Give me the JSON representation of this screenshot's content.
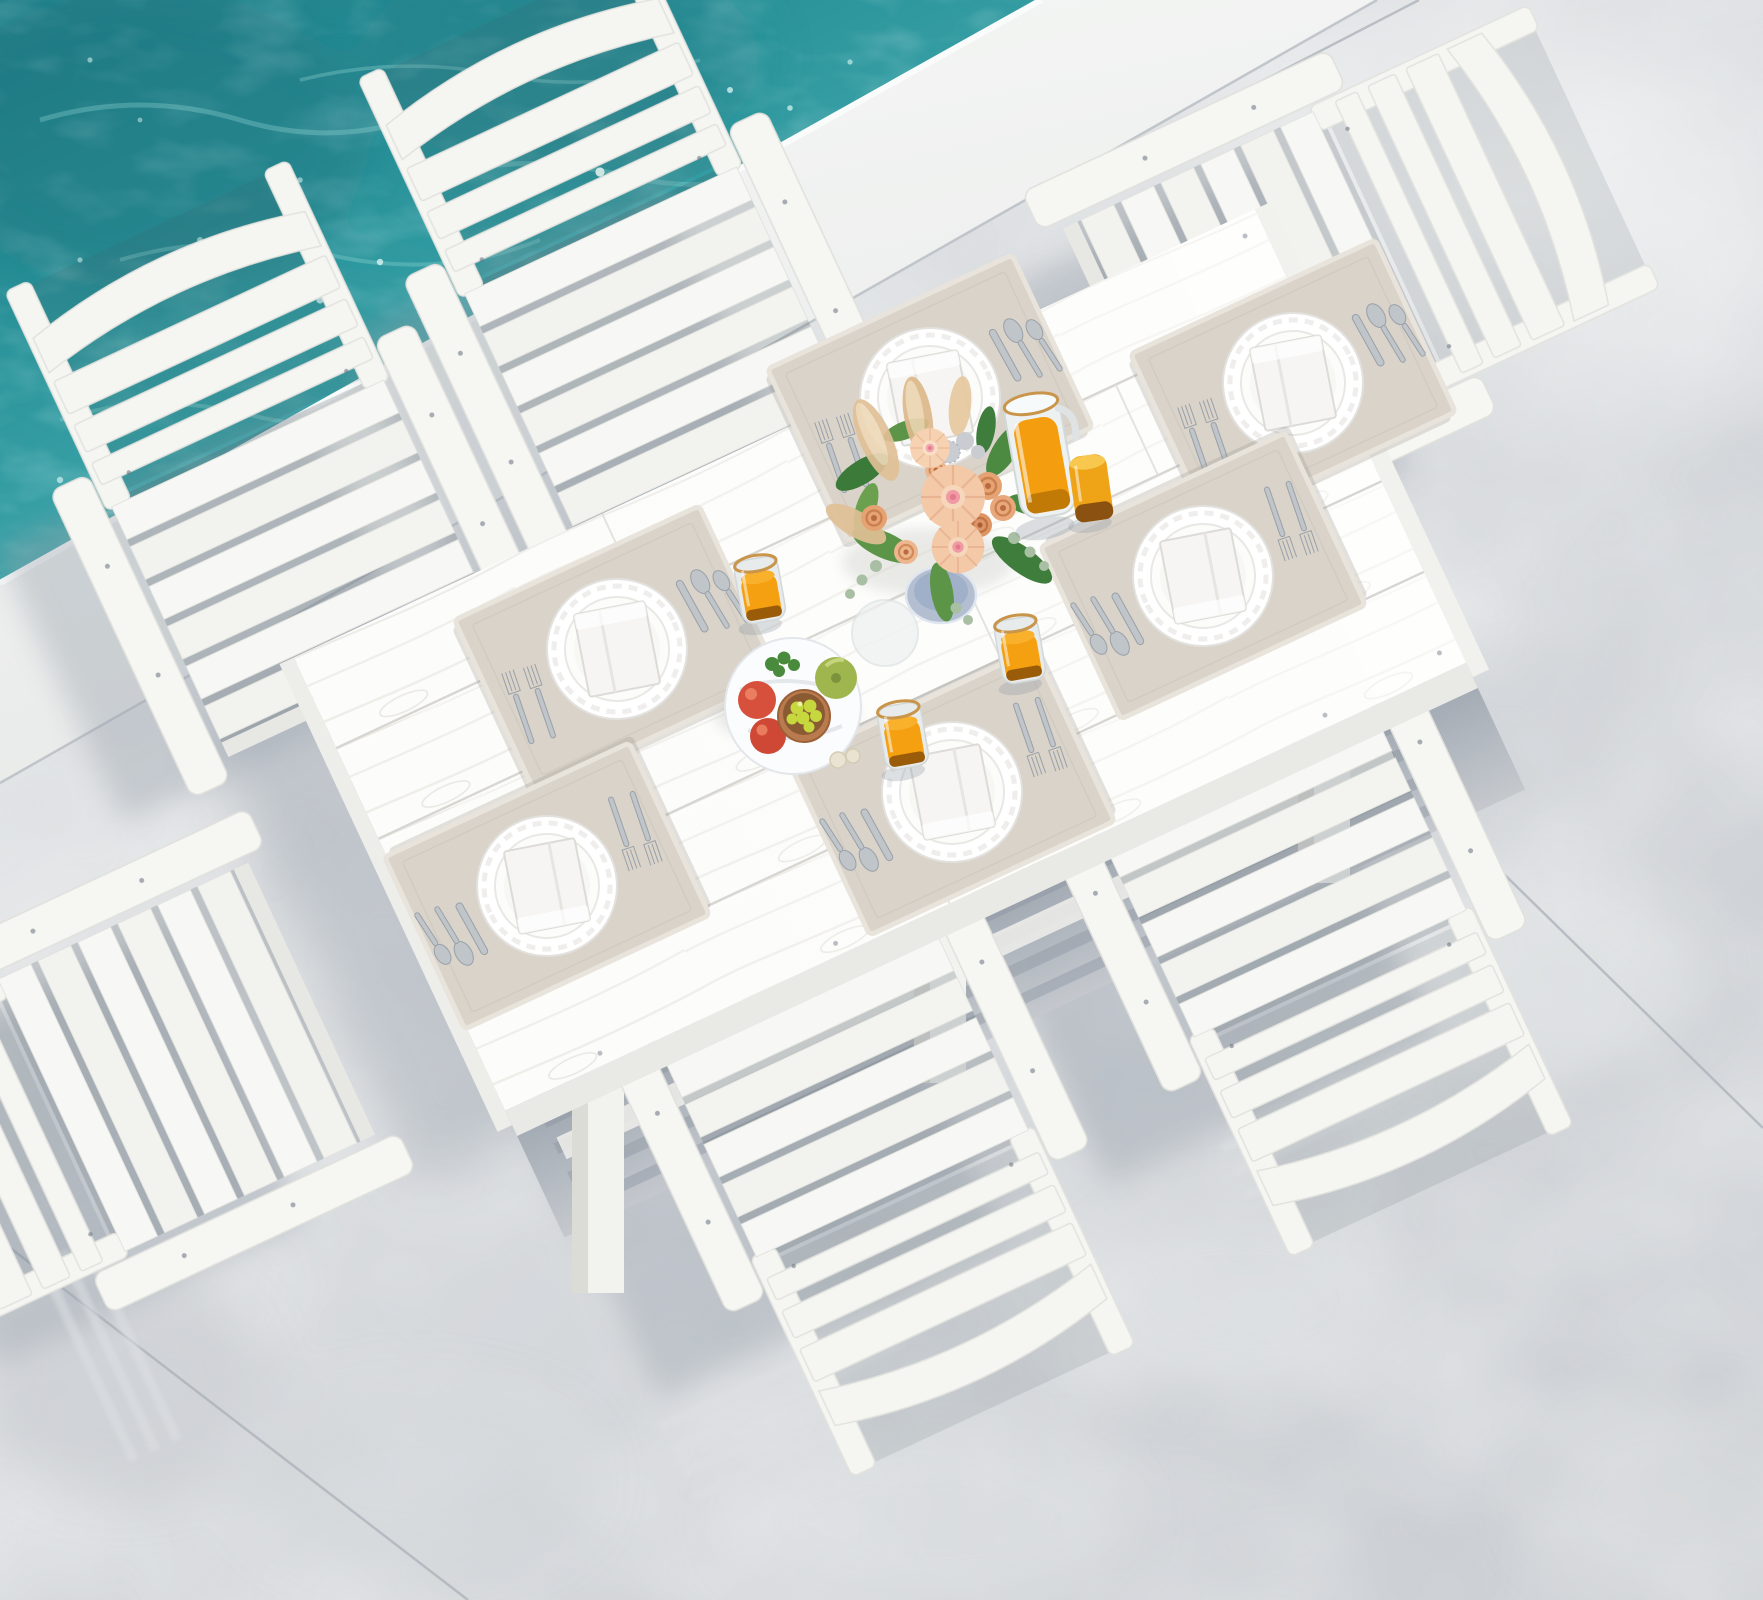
{
  "scene": {
    "description": "Aerial product photo: white 7-piece plastic outdoor dining set (rectangular slatted table with six armchairs) set for breakfast on a concrete pool deck beside turquoise pool water",
    "environment": {
      "pool_water": "turquoise pool water with ripples and sun sparkles, upper left",
      "pool_coping": "white stone pool edge band running diagonally",
      "patio": "light gray concrete patio with expansion joints and soft furniture shadows",
      "lighting": "bright sunlight from upper right, soft blue-gray shadows cast toward lower left"
    },
    "colors": {
      "water_deep": "#1f7e88",
      "water_mid": "#38a4a9",
      "water_light": "#6ec6c8",
      "sparkle": "#eafffb",
      "coping_white": "#f2f3f2",
      "concrete": "#d8dbde",
      "shadow_blue_gray": "#9aa3ad",
      "furniture_white": "#f6f6f4",
      "tabletop_white": "#fcfcfa",
      "placemat_beige": "#d8d2c9",
      "orange_juice": "#f5a011",
      "gold_rim": "#c8954a",
      "amber_glass": "#eda016",
      "dahlia_peach": "#f3c9a8",
      "dahlia_center_pink": "#ef9aa4",
      "rose_peach": "#e5a273",
      "foliage_green": "#4c8a42",
      "pampas_tan": "#e0c096",
      "vase_blue_gray": "#b3bfd1",
      "apple_red": "#d6503c",
      "apple_green": "#9fb54e",
      "grapes_yellow": "#c6d83e",
      "copper_bowl": "#b97b4e"
    },
    "furniture": {
      "table": {
        "label": "rectangular white wood-grain slatted dining table",
        "planks": 5,
        "legs_visible": 3
      },
      "chairs": {
        "count": 6,
        "label": "white slatted armchairs with horizontal-rail curved backrests",
        "positions": [
          "top left",
          "top center",
          "right head",
          "bottom right",
          "bottom center",
          "bottom left"
        ]
      }
    },
    "tabletop_items": {
      "place_settings": {
        "count": 6,
        "label": "six place settings on beige linen placemats",
        "components": [
          "beige linen placemat",
          "white scalloped charger plate",
          "white dinner plate",
          "folded white napkin",
          "two forks",
          "knife",
          "two spoons"
        ]
      },
      "centerpiece": {
        "label": "bouquet of peach dahlias and roses with greenery, eucalyptus and pampas grass in a blue-gray vase"
      },
      "drinks": {
        "pitcher": "glass pitcher full of orange juice with gold rim",
        "juice_glasses": 3,
        "juice_glass_label": "gold-rimmed glass of orange juice",
        "amber_tumbler": 1,
        "amber_tumbler_label": "goldenrod amber tumbler"
      },
      "fruit_platter": {
        "label": "white marble platter with red apples, a green apple, a copper bowl of yellow grapes, parsley and garlic"
      },
      "coaster": "frosted glass coaster"
    }
  }
}
